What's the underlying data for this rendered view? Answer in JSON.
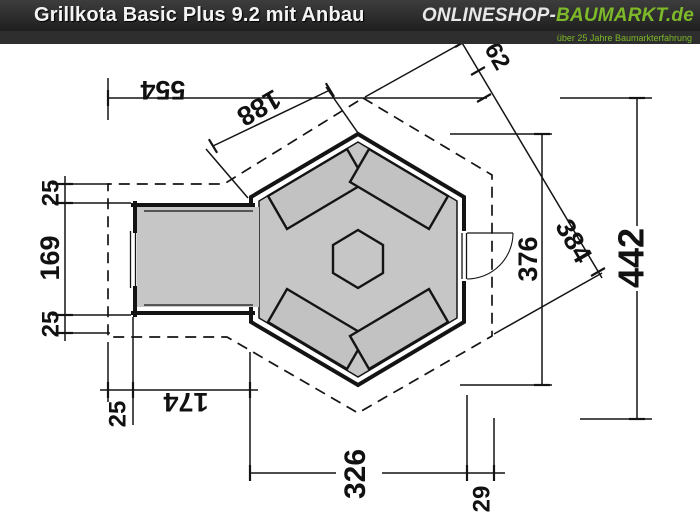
{
  "header": {
    "title": "Grillkota Basic Plus 9.2 mit Anbau",
    "brand_left": "ONLINESHOP-",
    "brand_right": "BAUMARKT.de",
    "tagline": "über 25 Jahre Baumarkterfahrung"
  },
  "colors": {
    "accent_green": "#7db928",
    "floor_gray": "#c6c6c6"
  },
  "drawing": {
    "description": "floor plan, hexagonal grill hut with annex, dimensions in cm",
    "dimensions": [
      {
        "id": "dim-554",
        "text": "554"
      },
      {
        "id": "dim-188",
        "text": "188"
      },
      {
        "id": "dim-62",
        "text": "62"
      },
      {
        "id": "dim-384",
        "text": "384"
      },
      {
        "id": "dim-376",
        "text": "376"
      },
      {
        "id": "dim-442",
        "text": "442"
      },
      {
        "id": "dim-25-left-top",
        "text": "25"
      },
      {
        "id": "dim-169",
        "text": "169"
      },
      {
        "id": "dim-25-left-bottom",
        "text": "25"
      },
      {
        "id": "dim-174",
        "text": "174"
      },
      {
        "id": "dim-25-annex",
        "text": "25"
      },
      {
        "id": "dim-326",
        "text": "326"
      },
      {
        "id": "dim-29",
        "text": "29"
      }
    ]
  }
}
